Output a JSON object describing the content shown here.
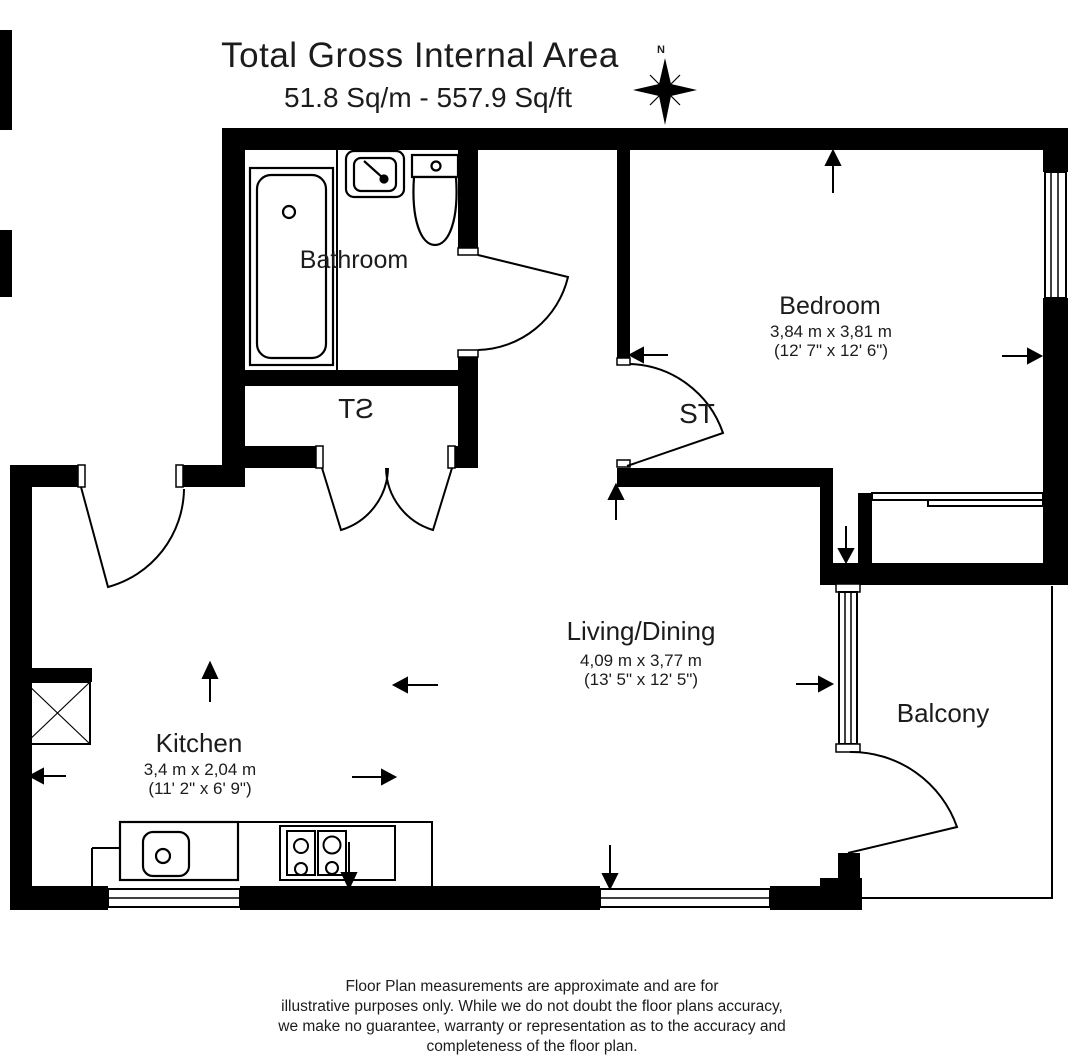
{
  "title": {
    "line1": "Total Gross Internal Area",
    "line2": "51.8 Sq/m - 557.9 Sq/ft"
  },
  "compass": {
    "north_label": "N"
  },
  "rooms": {
    "bathroom": {
      "name": "Bathroom"
    },
    "storage_hall": {
      "name": "ST"
    },
    "storage_bedroom": {
      "name": "ST"
    },
    "bedroom": {
      "name": "Bedroom",
      "size_metric": "3,84 m x 3,81 m",
      "size_imperial": "(12' 7\" x 12' 6\")"
    },
    "living_dining": {
      "name": "Living/Dining",
      "size_metric": "4,09 m x 3,77 m",
      "size_imperial": "(13' 5\" x 12' 5\")"
    },
    "kitchen": {
      "name": "Kitchen",
      "size_metric": "3,4 m x 2,04 m",
      "size_imperial": "(11' 2\" x 6' 9\")"
    },
    "balcony": {
      "name": "Balcony"
    }
  },
  "footer": {
    "lines": [
      "Floor Plan measurements are approximate and are for",
      "illustrative purposes only.  While we do not doubt the floor plans accuracy,",
      "we make no guarantee, warranty or representation as to the accuracy and",
      "completeness of the floor plan."
    ]
  },
  "colors": {
    "wall": "#000000",
    "line": "#1c1c1c",
    "background": "#ffffff"
  }
}
